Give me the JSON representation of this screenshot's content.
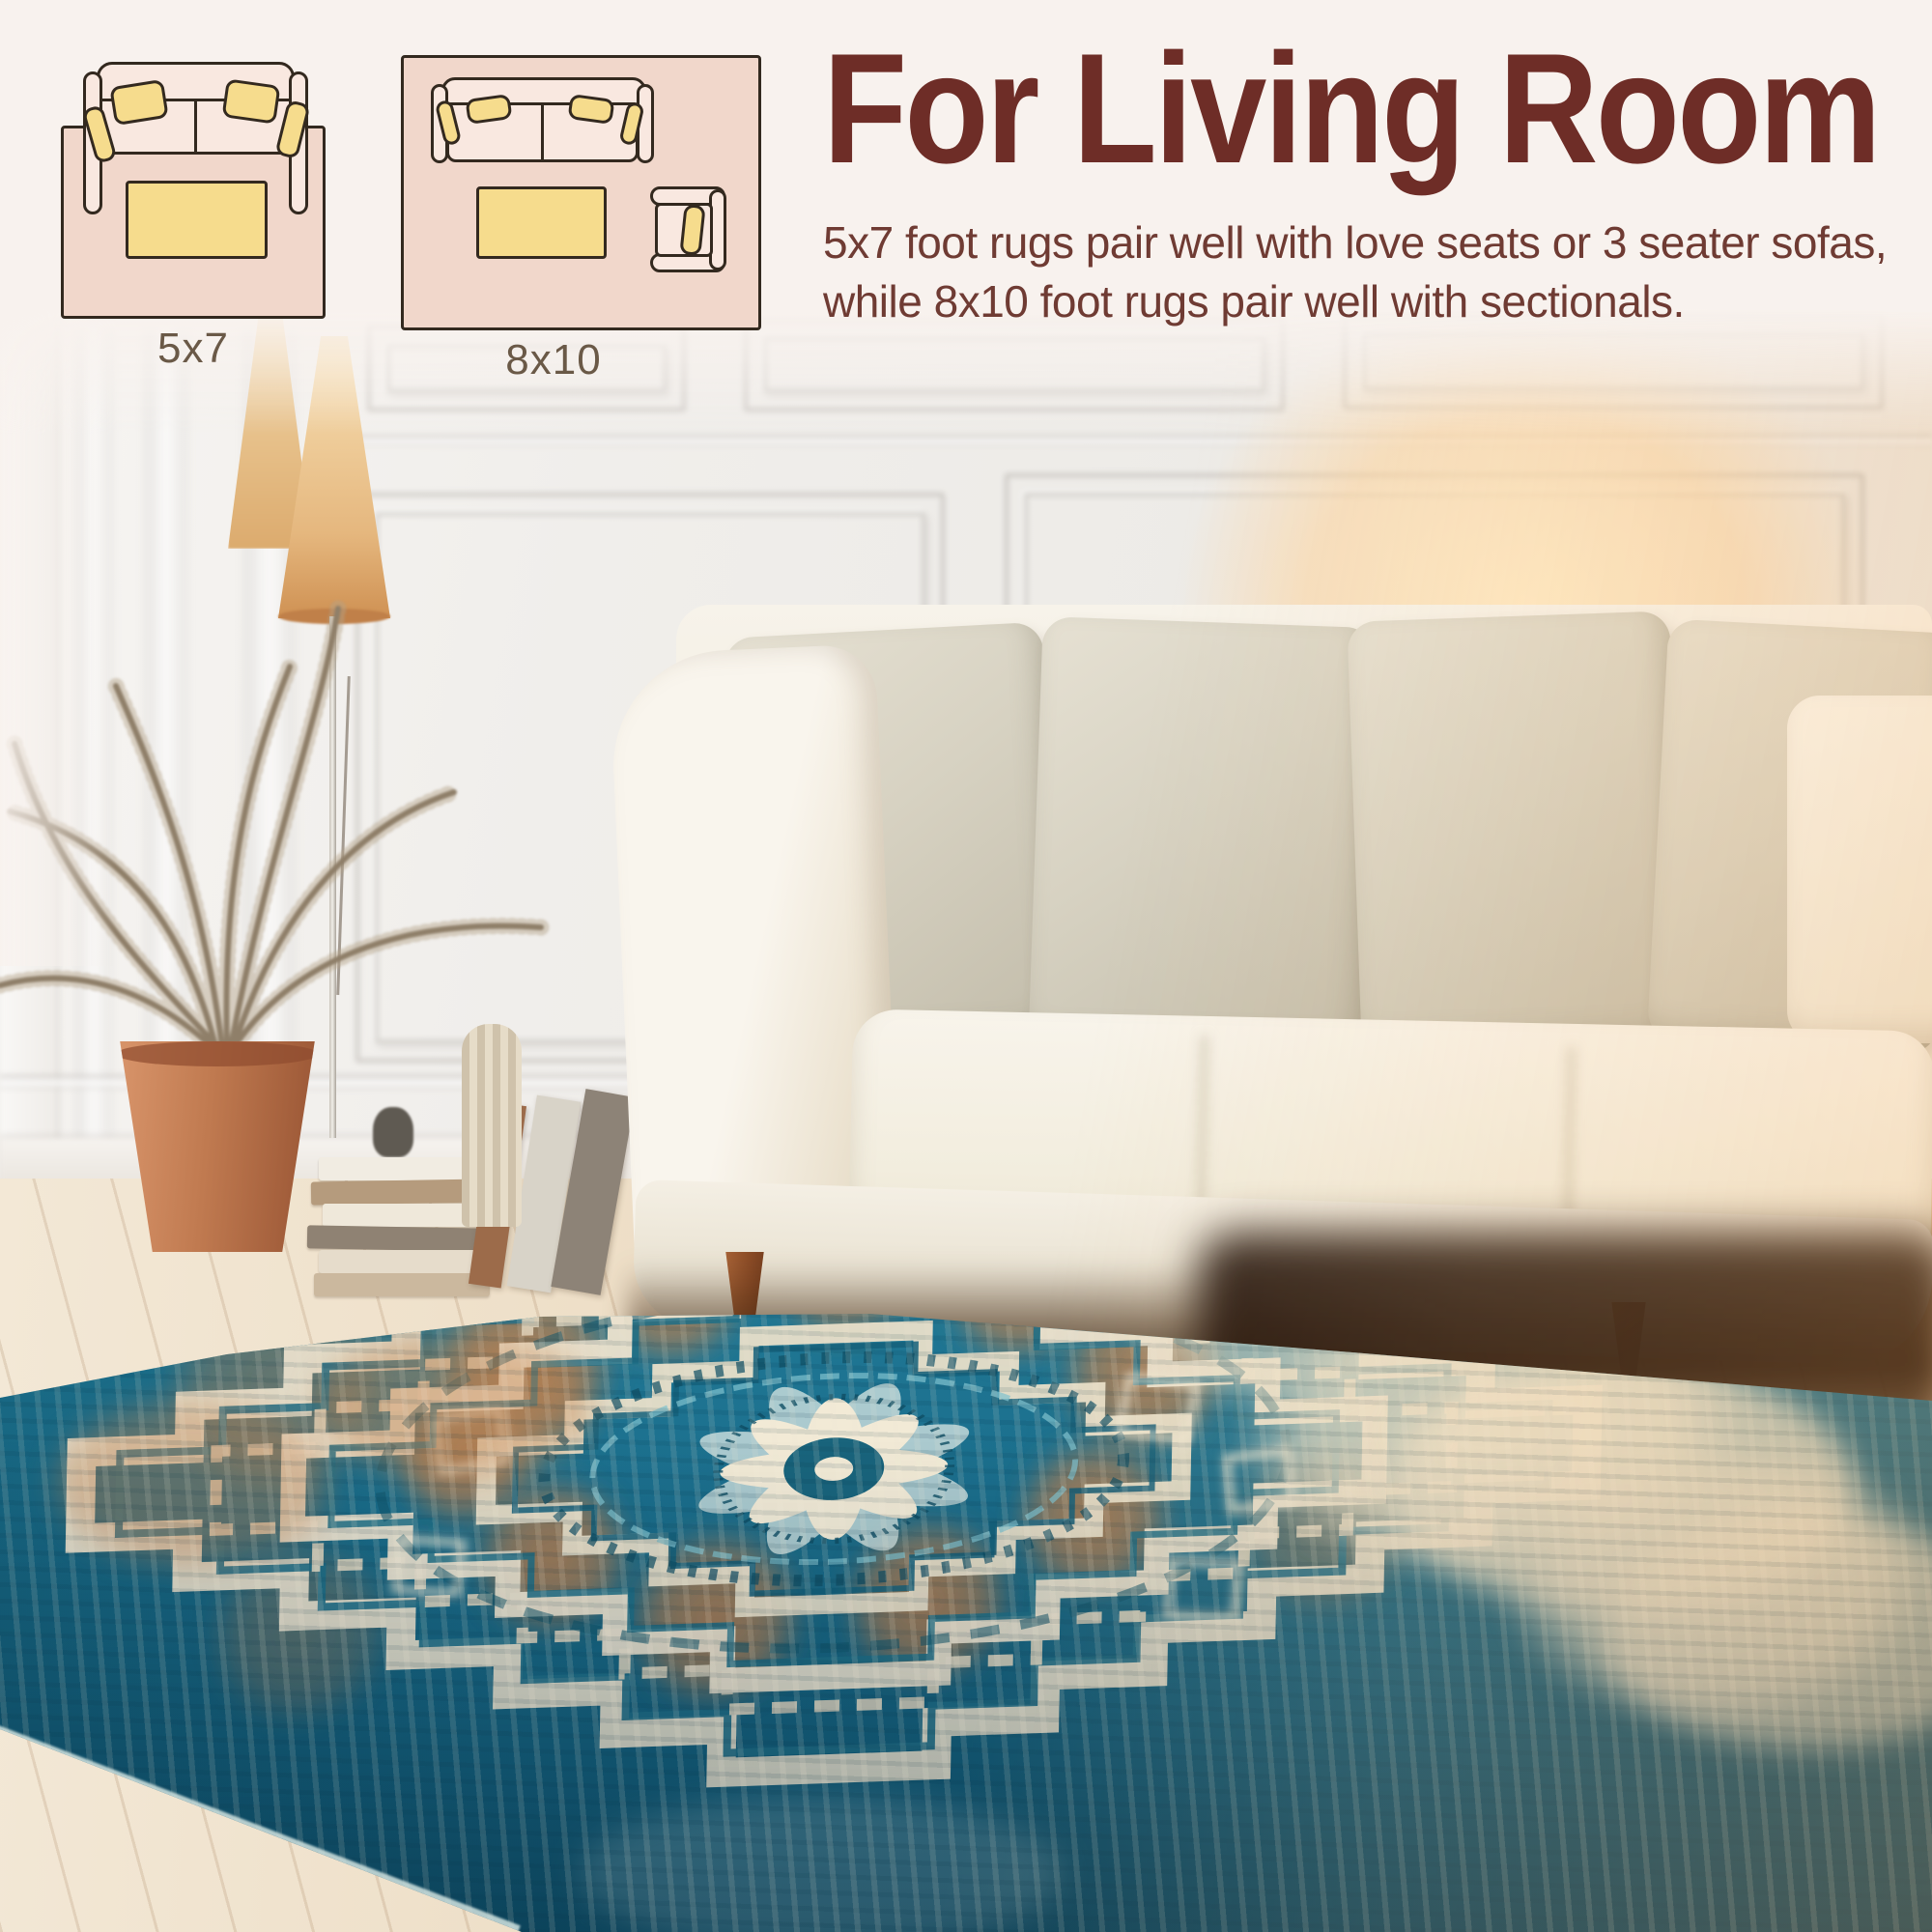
{
  "header": {
    "title": "For Living Room",
    "description": "5x7 foot rugs pair well with love seats or 3 seater sofas, while 8x10 foot rugs pair well with sectionals."
  },
  "size_diagrams": [
    {
      "label": "5x7"
    },
    {
      "label": "8x10"
    }
  ],
  "colors": {
    "background_cream": "#f8f2ee",
    "heading_maroon": "#6e2d27",
    "body_maroon": "#6f3b33",
    "label_brown": "#6a5947",
    "diagram_rug_pink": "#f1d7cb",
    "diagram_sofa_pink": "#f9e8e0",
    "diagram_pillow_yellow": "#f6dc8d",
    "diagram_outline": "#33291f",
    "rug_teal": "#2a8fa6",
    "rug_deep_teal": "#145e7a",
    "rug_orange": "#c77f49",
    "rug_ivory": "#eae1cb",
    "sofa_cream": "#f5f1e7",
    "pot_terracotta": "#c07a50"
  }
}
